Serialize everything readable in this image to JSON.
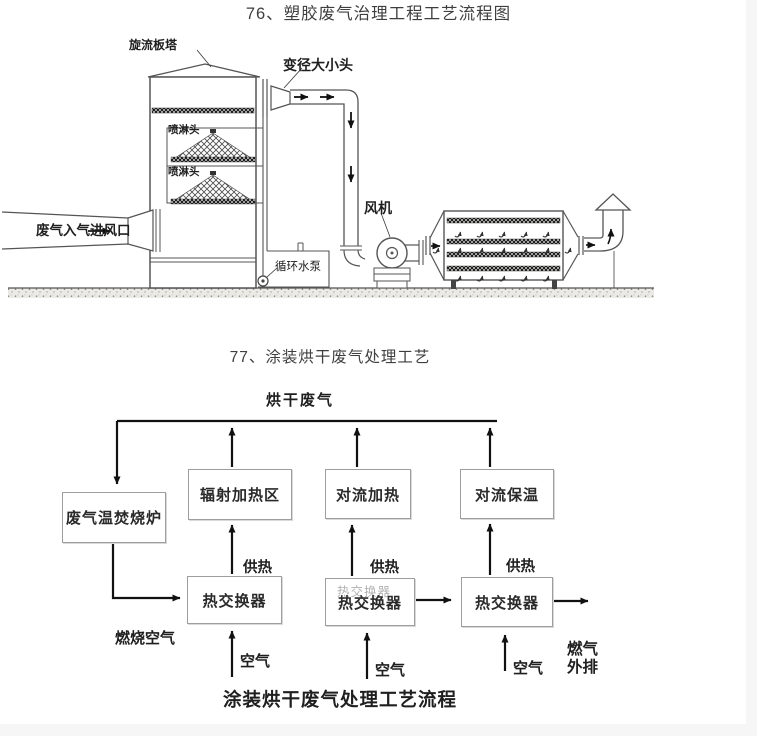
{
  "colors": {
    "ink": "#1f1f1f",
    "diagram_line": "#555555",
    "flow_line": "#111111",
    "box_border": "#9e9e9e",
    "title_text": "#3f3f3f"
  },
  "figure1": {
    "title": "76、塑胶废气治理工程工艺流程图",
    "labels": {
      "tower": "旋流板塔",
      "reducer": "变径大小头",
      "spray1": "喷淋头",
      "spray2": "喷淋头",
      "inlet": "废气入气进风口",
      "pump": "循环水泵",
      "fan": "风机"
    }
  },
  "figure2": {
    "title": "77、涂装烘干废气处理工艺",
    "top_label": "烘干废气",
    "boxes": {
      "incinerator": "废气温焚烧炉",
      "radiant_zone": "辐射加热区",
      "convection_heating": "对流加热",
      "convection_holding": "对流保温",
      "hx1": "热交换器",
      "hx2": "热交换器",
      "hx2_ghost": "热交换器",
      "hx3": "热交换器"
    },
    "labels": {
      "supply1": "供热",
      "supply2": "供热",
      "supply3": "供热",
      "combustion_air": "燃烧空气",
      "air1": "空气",
      "air2": "空气",
      "air3": "空气",
      "exhaust_line1": "燃气",
      "exhaust_line2": "外排"
    },
    "caption": "涂装烘干废气处理工艺流程"
  }
}
